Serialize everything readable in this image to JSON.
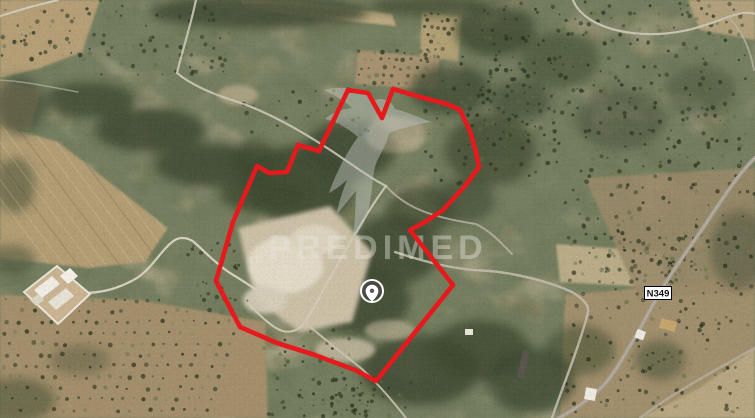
{
  "map": {
    "view": "satellite",
    "watermark": {
      "text": "PREDIMED",
      "logo": "hummingbird",
      "x": 378,
      "y": 247
    },
    "road_badge": {
      "label": "N349",
      "x": 658,
      "y": 293
    },
    "marker": {
      "icon": "location-pin",
      "x": 372,
      "y": 291
    },
    "boundary": {
      "color": "#e6191c",
      "stroke_width": 4.6,
      "points": [
        [
          348,
          90
        ],
        [
          368,
          93
        ],
        [
          382,
          118
        ],
        [
          393,
          89
        ],
        [
          420,
          97
        ],
        [
          447,
          104
        ],
        [
          460,
          110
        ],
        [
          470,
          131
        ],
        [
          476,
          152
        ],
        [
          479,
          167
        ],
        [
          465,
          186
        ],
        [
          443,
          210
        ],
        [
          425,
          222
        ],
        [
          410,
          230
        ],
        [
          453,
          285
        ],
        [
          376,
          381
        ],
        [
          355,
          370
        ],
        [
          315,
          355
        ],
        [
          277,
          343
        ],
        [
          240,
          327
        ],
        [
          216,
          281
        ],
        [
          233,
          222
        ],
        [
          257,
          166
        ],
        [
          269,
          173
        ],
        [
          287,
          172
        ],
        [
          298,
          145
        ],
        [
          319,
          151
        ]
      ]
    }
  }
}
